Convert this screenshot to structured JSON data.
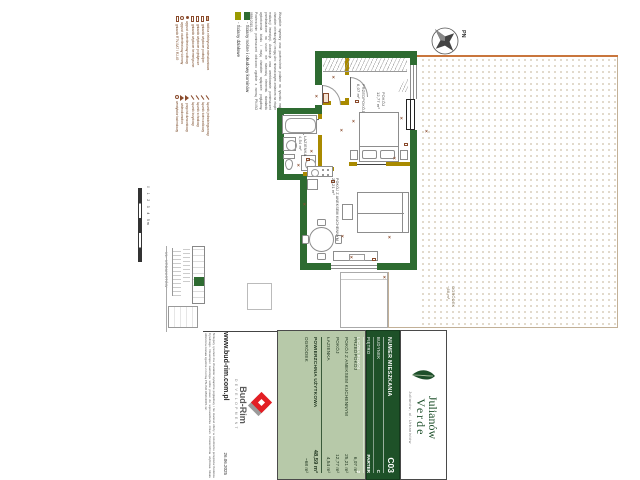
{
  "legend": {
    "wall_types": [
      {
        "color": "#2e6b31",
        "label": "- Ściany nośne i obudowy kominów"
      },
      {
        "color": "#9a9a00",
        "label": "- Ściany działowe"
      }
    ],
    "symbols_electrical": [
      "tablica elektryczna mieszkaniowa",
      "gniazdo wtykowe podwójne",
      "gniazdo wtykowe pojedyncze",
      "gniazdo wtykowe hermetyczne",
      "wypust oświetleniowy sufitowy",
      "wypust oświetleniowy ścienny",
      "gniazdo RTV-SAT / RJ-45"
    ],
    "symbols_switches": [
      "łącznik jednobiegunowy",
      "łącznik świecznikowy",
      "łącznik schodowy",
      "łącznik krzyżowy",
      "przycisk dzwonkowy",
      "wideodomofon",
      "wentylator łazienkowy"
    ],
    "note": "Wszystkie wymiary oraz powierzchnie podane na rysunku mają charakter orientacyjny i mogą ulec nieznacznym zmianom na etapie realizacji inwestycji. Aranżacja oraz umeblowanie pomieszczeń przedstawione na rzucie nie stanowią elementu standardu wykończenia lokalu i mają charakter wyłącznie poglądowy. Powierzchnie pomieszczeń obliczono zgodnie z normą PN-ISO 9836:2015-12."
  },
  "plan": {
    "compass_label": "PN",
    "scale_text": "0     1     2     3     4     5 m",
    "street": "UL. URBANISTÓW"
  },
  "rooms": [
    {
      "name": "PRZEDPOKÓJ",
      "area": "6,07 m²"
    },
    {
      "name": "POKÓJ Z ANEKSEM KUCHENNYM",
      "area": "25,21 m²"
    },
    {
      "name": "POKÓJ",
      "area": "12,77 m²"
    },
    {
      "name": "ŁAZIENKA",
      "area": "4,54 m²"
    }
  ],
  "total": {
    "label": "POWIERZCHNIA UŻYTKOWA",
    "value": "48,59 m²"
  },
  "garden": {
    "name": "OGRÓDEK",
    "area": "~68 m²"
  },
  "titleblock": {
    "apartment_label": "NUMER MIESZKANIA",
    "apartment_value": "C03",
    "fields": [
      {
        "label": "BUDYNEK",
        "value": "C"
      },
      {
        "label": "PIĘTRO",
        "value": "PARTER"
      },
      {
        "label": "LICZBA POKOI",
        "value": "2"
      }
    ],
    "brand": {
      "line1": "Julianów",
      "line2": "Verde",
      "subtitle": "Julianów, ul. Urbanistów"
    },
    "developer": {
      "url": "www.bud-rim.com.pl",
      "date": "26.06.2025",
      "name": "Bud-Rim",
      "tagline": "DEVELOPMENT"
    },
    "disclaimer": "Niniejszy rysunek ma charakter wyłącznie poglądowy i nie stanowi oferty w rozumieniu przepisów Kodeksu Cywilnego. Deweloper zastrzega sobie prawo do wprowadzania zmian. Powierzchnia użytkowa lokalu obliczona została zgodnie z normą PN-ISO 9836:2015-12."
  }
}
